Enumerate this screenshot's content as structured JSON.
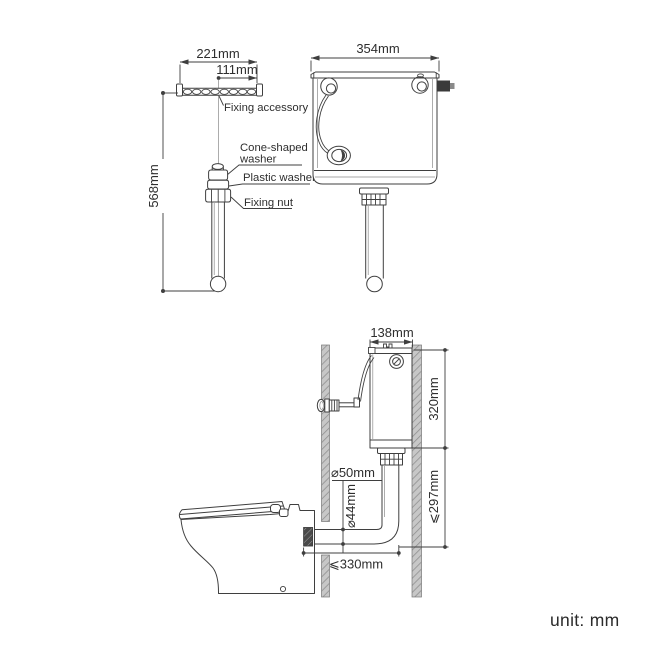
{
  "page": {
    "unit_note": "unit: mm"
  },
  "colors": {
    "line": "#3f3f3f",
    "text": "#2e2e2e",
    "wall_fill": "#c7c7c7",
    "wall_hatch": "#8d8d8d",
    "connector_fill": "#4a4a4a"
  },
  "top_left_diagram": {
    "width_dim": "221mm",
    "half_width_dim": "111mm",
    "height_dim": "568mm",
    "labels": {
      "fixing_accessory": "Fixing accessory",
      "cone_washer_1": "Cone-shaped",
      "cone_washer_2": "washer",
      "plastic_washer": "Plastic washer",
      "fixing_nut": "Fixing nut"
    }
  },
  "top_right_diagram": {
    "width_dim": "354mm"
  },
  "bottom_diagram": {
    "cistern_depth_dim": "138mm",
    "cistern_height_dim": "320mm",
    "outlet_height_dim": "⩽297mm",
    "flush_pipe_diameter": "⌀50mm",
    "inlet_pipe_diameter": "⌀44mm",
    "horizontal_offset_dim": "⩽330mm"
  }
}
